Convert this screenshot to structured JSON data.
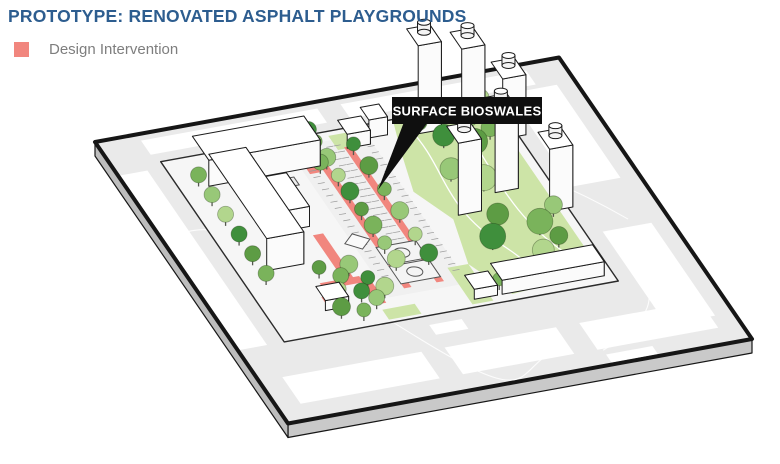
{
  "title": "PROTOTYPE: RENOVATED ASPHALT PLAYGROUNDS",
  "legend": {
    "label": "Design Intervention"
  },
  "callout": {
    "label": "SURFACE BIOSWALES"
  },
  "colors": {
    "title_text": "#2d5d8f",
    "legend_text": "#7e7e7e",
    "accent_pink": "#f1867e",
    "lawn_green": "#cde4a7",
    "tree_greens": [
      "#5d9c44",
      "#7ab35b",
      "#98c878",
      "#b2d68d",
      "#3f8f3c"
    ],
    "street_gray": "#eaeaea",
    "slab_side_gray": "#c9c9c9",
    "block_ground": "#f6f6f6",
    "outline_black": "#161616",
    "callout_bg": "#0f0f0f",
    "callout_text": "#ffffff",
    "building_top": "#ffffff",
    "building_front": "#fbfbfb",
    "building_side": "#e7e7e7"
  }
}
